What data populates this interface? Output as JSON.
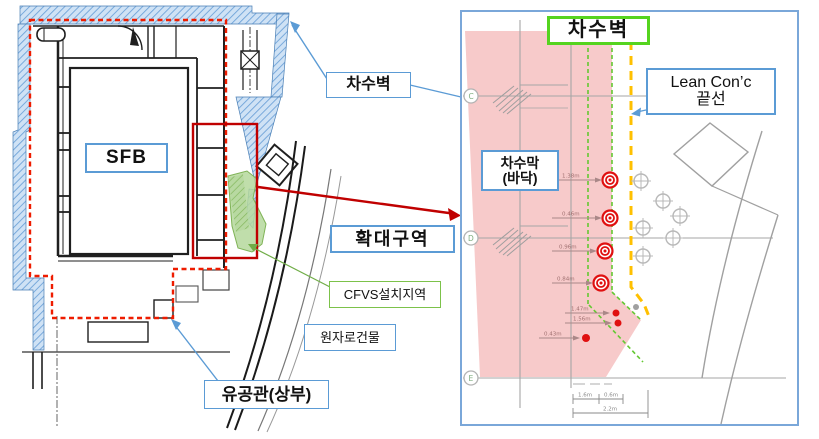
{
  "left_panel": {
    "sfb_label": "SFB",
    "chasubyeok_label": "차수벽",
    "hwakdae_label": "확대구역",
    "cfvs_label": "CFVS설치지역",
    "wonjaro_label": "원자로건물",
    "yugonggwan_label": "유공관(상부)"
  },
  "right_panel": {
    "chasubyeok_label": "차수벽",
    "lean_conc_label_line1": "Lean Con’c",
    "lean_conc_label_line2": "끝선",
    "chasumak_label_line1": "차수막",
    "chasumak_label_line2": "(바닥)",
    "grid_markers": {
      "c": "C",
      "d": "D",
      "e": "E"
    },
    "target_dims": [
      "1.38m",
      "0.46m",
      "0.96m",
      "0.84m"
    ],
    "dot_dims": [
      "1.47m",
      "1.56m",
      "0.43m"
    ],
    "bottom_dims": [
      "1.6m",
      "0.6m",
      "2.2m"
    ]
  },
  "colors": {
    "barrier_hatch_blue": "#6fa3d8",
    "barrier_fill_blue": "#cfe2f5",
    "boundary_dash_red": "#ee1c00",
    "zoom_box_red": "#c00000",
    "cfvs_green_fill": "#b5d89c",
    "label_border_blue": "#5b9bd5",
    "label_border_green": "#55d41f",
    "membrane_pink": "#f7caca",
    "lean_conc_yellow": "#ffc000",
    "barrier_dash_green": "#64c832",
    "target_red": "#e01010"
  }
}
